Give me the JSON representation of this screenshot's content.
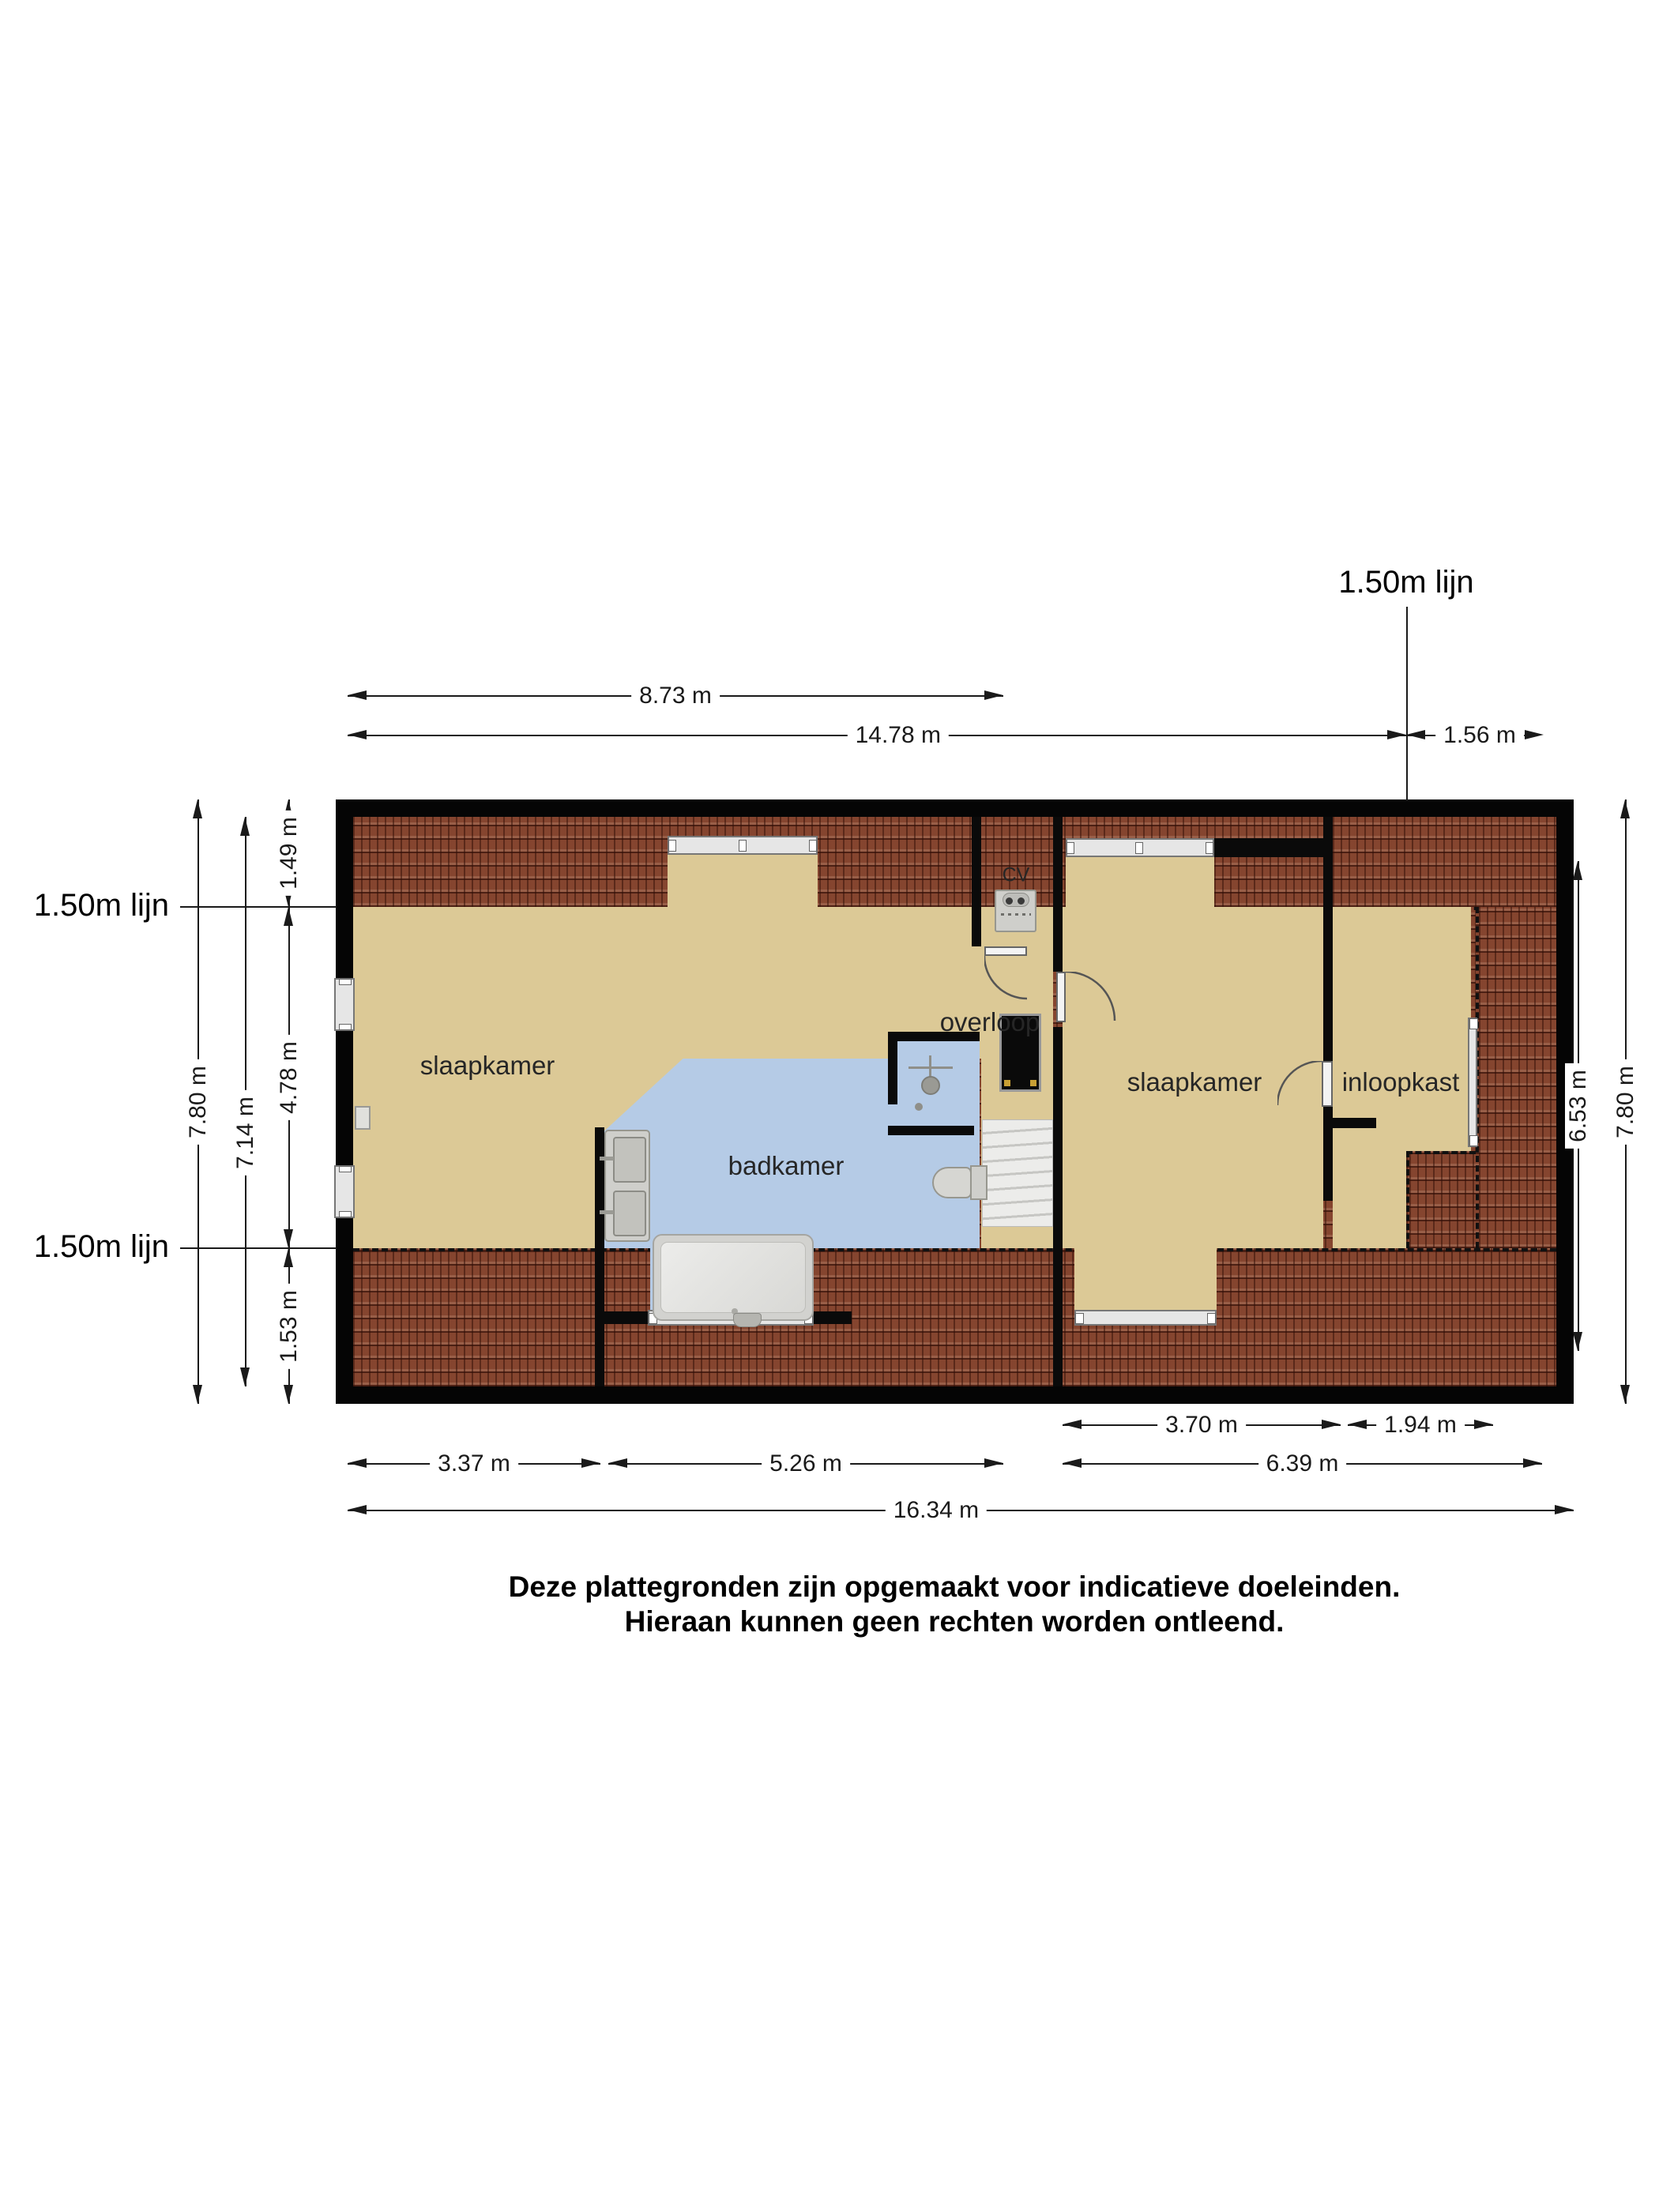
{
  "plan": {
    "line_markers": {
      "top_right": "1.50m lijn",
      "left_upper": "1.50m lijn",
      "left_lower": "1.50m lijn"
    },
    "rooms": [
      {
        "id": "bedroom-left",
        "label": "slaapkamer"
      },
      {
        "id": "bathroom",
        "label": "badkamer"
      },
      {
        "id": "landing",
        "label": "overloop"
      },
      {
        "id": "bedroom-right",
        "label": "slaapkamer"
      },
      {
        "id": "walk-in-closet",
        "label": "inloopkast"
      },
      {
        "id": "central-heating",
        "label": "CV"
      }
    ],
    "dimensions": {
      "top": [
        "8.73 m",
        "14.78 m",
        "1.56 m"
      ],
      "left": [
        "7.80 m",
        "7.14 m",
        "1.49 m",
        "4.78 m",
        "1.53 m"
      ],
      "right": [
        "6.53 m",
        "7.80 m"
      ],
      "bottom": [
        "3.70 m",
        "1.94 m",
        "3.37 m",
        "5.26 m",
        "6.39 m",
        "16.34 m"
      ]
    },
    "disclaimer": {
      "line1": "Deze plattegronden zijn opgemaakt voor indicatieve doeleinden.",
      "line2": "Hieraan kunnen geen rechten worden ontleend."
    },
    "colors": {
      "floor": "#dcc996",
      "bathroom_floor": "#b5cbe6",
      "roof_tiles": "#85452f",
      "walls": "#050505",
      "dimension_lines": "#1a1a1a"
    }
  }
}
